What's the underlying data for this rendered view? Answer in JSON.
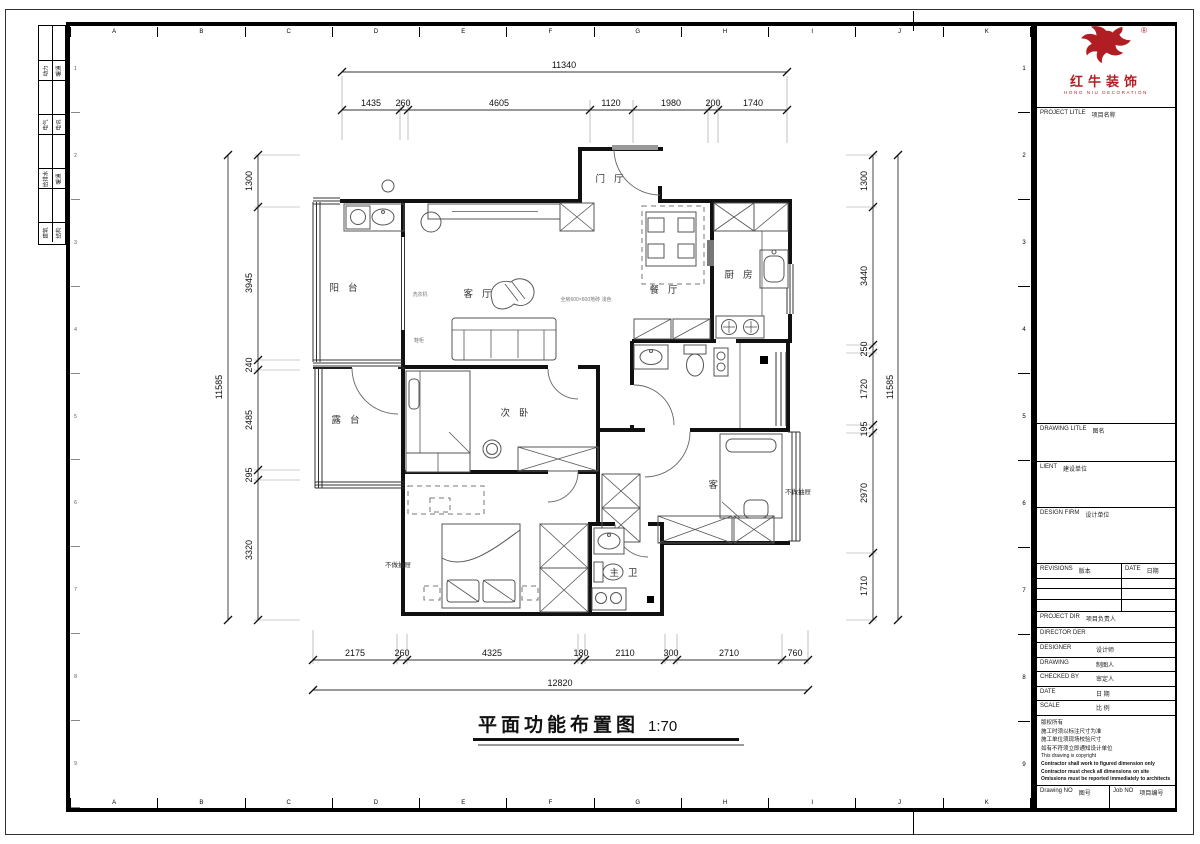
{
  "sheet": {
    "frame_letters": [
      "A",
      "B",
      "C",
      "D",
      "E",
      "F",
      "G",
      "H",
      "I",
      "J",
      "K"
    ],
    "frame_numbers": [
      "1",
      "2",
      "3",
      "4",
      "5",
      "6",
      "7",
      "8",
      "9"
    ],
    "signature_rows": [
      {
        "l": "动力",
        "r": "暖通"
      },
      {
        "l": "电气",
        "r": "电讯"
      },
      {
        "l": "给排水",
        "r": "暖通"
      },
      {
        "l": "建筑",
        "r": "结构"
      }
    ]
  },
  "plan": {
    "title": "平面功能布置图",
    "scale": "1:70",
    "rooms": {
      "entry": "门厅",
      "balcony": "阳台",
      "living": "客厅",
      "dining": "餐厅",
      "kitchen": "厨房",
      "terrace": "露台",
      "second_bedroom": "次卧",
      "guest_bedroom": "客卧",
      "master_bedroom": "主卧",
      "master_bath": "主卫"
    },
    "annotations": {
      "no_drawer_left": "不做抽屉",
      "no_drawer_right": "不做抽屉",
      "washer": "洗衣机",
      "shoe_cabinet": "鞋柜",
      "floor_note": "全房600×600地砖 浅色"
    }
  },
  "dims": {
    "top": {
      "overall": "11340",
      "segments": [
        "1435",
        "260",
        "4605",
        "1120",
        "1980",
        "200",
        "1740"
      ]
    },
    "bottom": {
      "overall": "12820",
      "segments": [
        "2175",
        "260",
        "4325",
        "180",
        "2110",
        "300",
        "2710",
        "760"
      ]
    },
    "left": {
      "overall": "11585",
      "segments": [
        "1300",
        "3945",
        "240",
        "2485",
        "295",
        "3320"
      ]
    },
    "right": {
      "overall": "11585",
      "segments": [
        "1300",
        "3440",
        "250",
        "1720",
        "195",
        "2970",
        "1710"
      ]
    }
  },
  "title_block": {
    "logo": {
      "cn": "红牛装饰",
      "en": "HONG NIU DECORATION",
      "reg": "®"
    },
    "rows": [
      {
        "en": "PROJECT LITLE",
        "cn": "项目名称"
      },
      {
        "en": "DRAWING LITLE",
        "cn": "图名"
      },
      {
        "en": "LIENT",
        "cn": "建设单位"
      },
      {
        "en": "DESIGN FIRM",
        "cn": "设计单位"
      },
      {
        "en": "REVISIONS",
        "cn": "版本"
      },
      {
        "en": "DATE",
        "cn": "日期"
      },
      {
        "en": "PROJECT DIR",
        "cn": "项目负责人"
      },
      {
        "en": "DIRECTOR DER",
        "cn": ""
      },
      {
        "en": "DESIGNER",
        "cn": "设计师"
      },
      {
        "en": "DRAWING",
        "cn": "制图人"
      },
      {
        "en": "CHECKED BY",
        "cn": "审定人"
      },
      {
        "en": "DATE",
        "cn": "日 期"
      },
      {
        "en": "SCALE",
        "cn": "比 例"
      },
      {
        "en": "Drawing NO",
        "cn": "图号"
      },
      {
        "en": "Job NO",
        "cn": "项目编号"
      }
    ],
    "notes": {
      "cn0": "版权所有",
      "cn1": "施工时须以标注尺寸为准",
      "cn2": "施工单位须现场校验尺寸",
      "cn3": "如有不符须立即通知设计单位",
      "en_light": "This drawing is copyright",
      "en_b0": "Contractor shall work to figured dimension only",
      "en_b1": "Contractor must check all dimensions on site",
      "en_b2": "Omissions must be reported immediately to architects"
    }
  }
}
